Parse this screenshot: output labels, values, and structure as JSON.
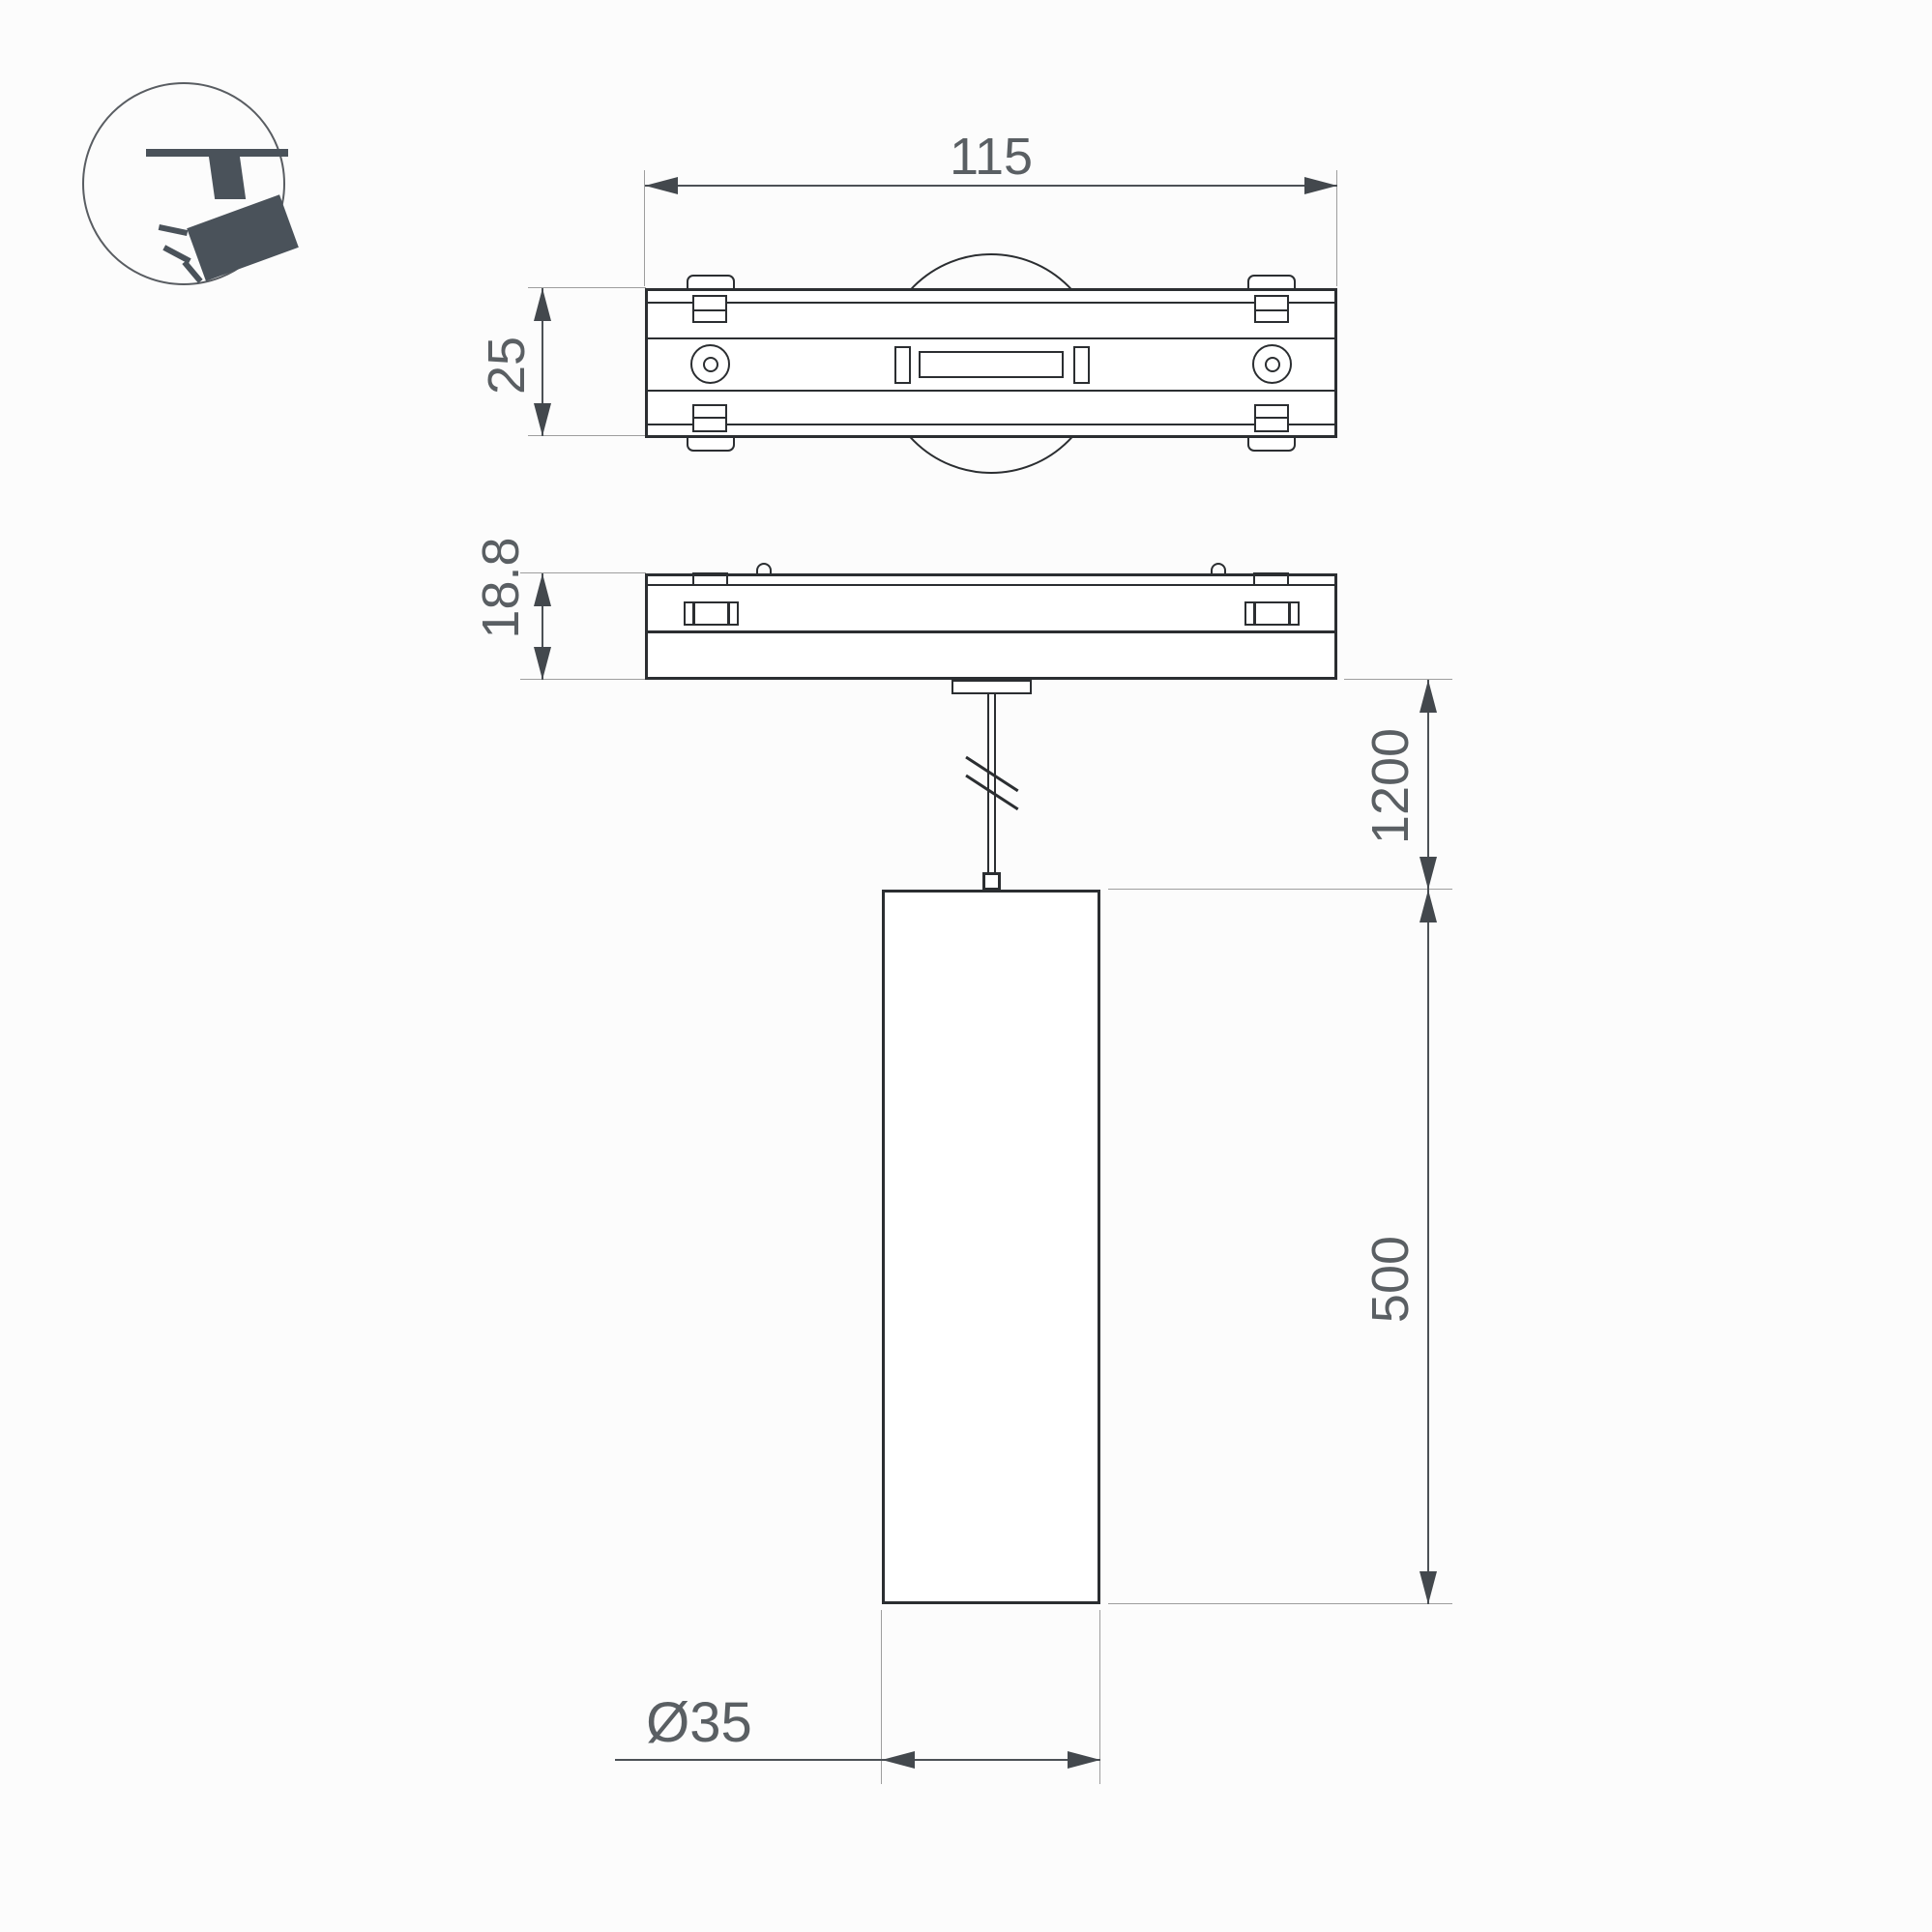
{
  "colors": {
    "bg": "#fcfcfc",
    "outline": "#2b2e31",
    "dim": "#4c5156",
    "ext": "#9e9e9e",
    "arrow": "#43484d",
    "text": "#5a5f63",
    "icon": "#4a525a"
  },
  "icon": {
    "name": "track-mounted-spotlight"
  },
  "dimensions": {
    "track_width": "115",
    "track_depth": "25",
    "adapter_height": "18.8",
    "suspension_length": "1200",
    "body_height": "500",
    "body_diameter": "Ø35"
  }
}
